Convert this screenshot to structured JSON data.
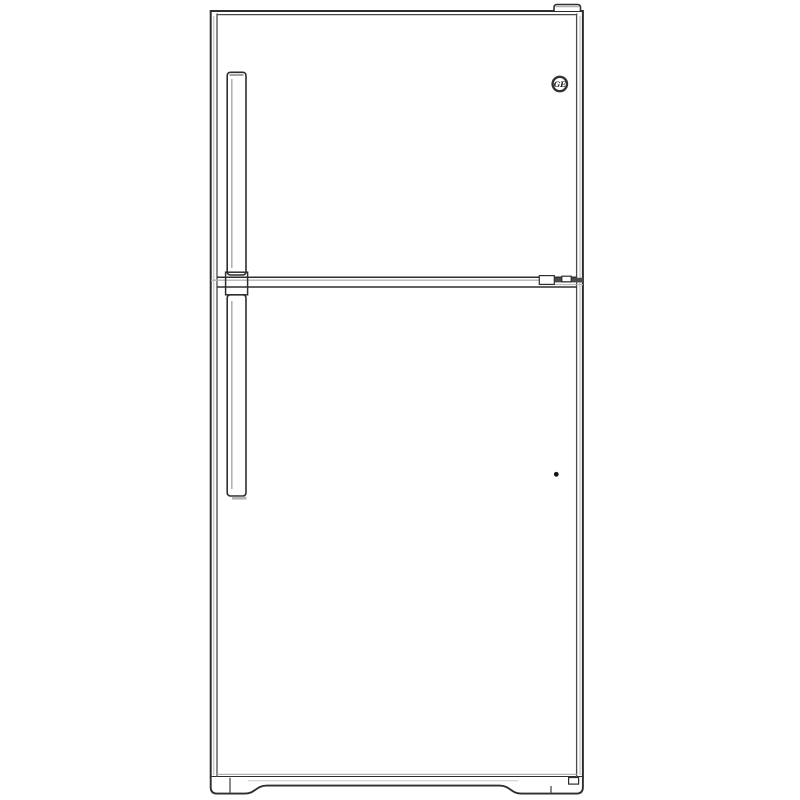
{
  "figure": {
    "description": "Line drawing of a GE top-freezer refrigerator, front view, left-mounted vertical door handles",
    "view": "front"
  },
  "brand": {
    "name": "GE",
    "monogram": "GE"
  },
  "colors": {
    "background": "#ffffff",
    "outline": "#2e2e2e",
    "shading": "#b3b3b3",
    "badge_ink": "#333333",
    "plug_dot": "#151515"
  },
  "icons": {
    "ge_monogram": "GE monogram badge (circle emblem)",
    "door_plug": "round door plug dot"
  },
  "parts": {
    "cabinet": "refrigerator cabinet",
    "freezer_door": "freezer door (top)",
    "fresh_food_door": "fresh food door (bottom)",
    "freezer_handle": "freezer door handle",
    "fresh_food_handle": "fresh food door handle",
    "top_hinge_cover": "top hinge cover",
    "center_hinge": "center door hinge",
    "base": "base / kick plate with leveling feet"
  }
}
